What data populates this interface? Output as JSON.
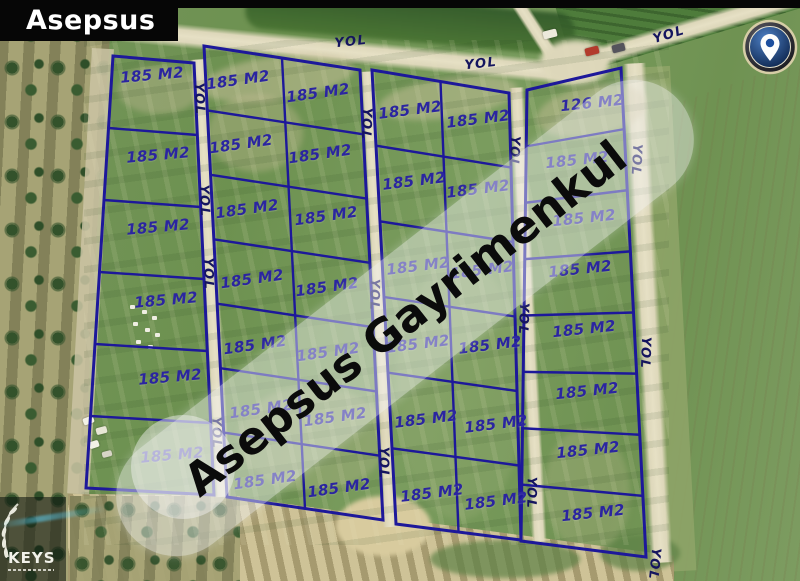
{
  "title_badge": {
    "text": "Asepsus"
  },
  "watermark": {
    "text": "Asepsus Gayrimenkul"
  },
  "logo": {
    "text": "KEYS"
  },
  "colors": {
    "parcel_line": "#1d189a",
    "parcel_label": "#2b25a0",
    "road_label": "#15155f",
    "band": "rgba(245,245,245,0.45)",
    "pin_blue": "#1d4f9e"
  },
  "map": {
    "road_labels": {
      "text": "YOL",
      "positions": [
        {
          "x": 351,
          "y": 42,
          "rot": -6
        },
        {
          "x": 481,
          "y": 64,
          "rot": -6
        },
        {
          "x": 669,
          "y": 35,
          "rot": -17
        },
        {
          "x": 199,
          "y": 99,
          "rot": 88
        },
        {
          "x": 204,
          "y": 201,
          "rot": 88
        },
        {
          "x": 208,
          "y": 274,
          "rot": 89
        },
        {
          "x": 216,
          "y": 433,
          "rot": 89
        },
        {
          "x": 366,
          "y": 124,
          "rot": 92
        },
        {
          "x": 374,
          "y": 295,
          "rot": 91
        },
        {
          "x": 383,
          "y": 463,
          "rot": 90
        },
        {
          "x": 514,
          "y": 152,
          "rot": 93
        },
        {
          "x": 523,
          "y": 319,
          "rot": 92
        },
        {
          "x": 531,
          "y": 493,
          "rot": 91
        },
        {
          "x": 636,
          "y": 160,
          "rot": 93
        },
        {
          "x": 645,
          "y": 353,
          "rot": 92
        },
        {
          "x": 654,
          "y": 564,
          "rot": 96
        }
      ]
    },
    "blocks": [
      {
        "name": "column-west",
        "corners": [
          [
            113,
            56
          ],
          [
            194,
            63
          ],
          [
            214,
            495
          ],
          [
            86,
            488
          ]
        ],
        "rows": 6,
        "cols": 1
      },
      {
        "name": "block-b",
        "corners": [
          [
            204,
            46
          ],
          [
            360,
            70
          ],
          [
            383,
            520
          ],
          [
            227,
            497
          ]
        ],
        "rows": 7,
        "cols": 2
      },
      {
        "name": "block-c",
        "corners": [
          [
            372,
            70
          ],
          [
            509,
            93
          ],
          [
            521,
            540
          ],
          [
            396,
            524
          ]
        ],
        "rows": 6,
        "cols": 2
      },
      {
        "name": "column-east",
        "corners": [
          [
            527,
            90
          ],
          [
            621,
            68
          ],
          [
            646,
            557
          ],
          [
            521,
            541
          ]
        ],
        "rows": 8,
        "cols": 1
      }
    ],
    "plots": [
      {
        "label": "185 M2",
        "x": 152,
        "y": 75,
        "rot": -5
      },
      {
        "label": "185 M2",
        "x": 158,
        "y": 155,
        "rot": -5
      },
      {
        "label": "185 M2",
        "x": 158,
        "y": 227,
        "rot": -5
      },
      {
        "label": "185 M2",
        "x": 166,
        "y": 300,
        "rot": -5
      },
      {
        "label": "185 M2",
        "x": 170,
        "y": 377,
        "rot": -5
      },
      {
        "label": "185 M2",
        "x": 172,
        "y": 455,
        "rot": -5
      },
      {
        "label": "185 M2",
        "x": 238,
        "y": 80,
        "rot": -8
      },
      {
        "label": "185 M2",
        "x": 318,
        "y": 93,
        "rot": -8
      },
      {
        "label": "185 M2",
        "x": 241,
        "y": 144,
        "rot": -8
      },
      {
        "label": "185 M2",
        "x": 320,
        "y": 154,
        "rot": -8
      },
      {
        "label": "185 M2",
        "x": 247,
        "y": 209,
        "rot": -8
      },
      {
        "label": "185 M2",
        "x": 326,
        "y": 216,
        "rot": -8
      },
      {
        "label": "185 M2",
        "x": 252,
        "y": 279,
        "rot": -8
      },
      {
        "label": "185 M2",
        "x": 327,
        "y": 287,
        "rot": -8
      },
      {
        "label": "185 M2",
        "x": 255,
        "y": 345,
        "rot": -8
      },
      {
        "label": "185 M2",
        "x": 328,
        "y": 352,
        "rot": -8
      },
      {
        "label": "185 M2",
        "x": 261,
        "y": 409,
        "rot": -8
      },
      {
        "label": "185 M2",
        "x": 335,
        "y": 417,
        "rot": -8
      },
      {
        "label": "185 M2",
        "x": 265,
        "y": 480,
        "rot": -8
      },
      {
        "label": "185 M2",
        "x": 339,
        "y": 488,
        "rot": -8
      },
      {
        "label": "185 M2",
        "x": 410,
        "y": 110,
        "rot": -7
      },
      {
        "label": "185 M2",
        "x": 478,
        "y": 119,
        "rot": -7
      },
      {
        "label": "185 M2",
        "x": 414,
        "y": 181,
        "rot": -7
      },
      {
        "label": "185 M2",
        "x": 478,
        "y": 189,
        "rot": -7
      },
      {
        "label": "185 M2",
        "x": 418,
        "y": 266,
        "rot": -7
      },
      {
        "label": "185 M2",
        "x": 482,
        "y": 270,
        "rot": -7
      },
      {
        "label": "185 M2",
        "x": 418,
        "y": 344,
        "rot": -7
      },
      {
        "label": "185 M2",
        "x": 490,
        "y": 345,
        "rot": -7
      },
      {
        "label": "185 M2",
        "x": 426,
        "y": 419,
        "rot": -7
      },
      {
        "label": "185 M2",
        "x": 496,
        "y": 424,
        "rot": -7
      },
      {
        "label": "185 M2",
        "x": 432,
        "y": 493,
        "rot": -7
      },
      {
        "label": "185 M2",
        "x": 496,
        "y": 501,
        "rot": -7
      },
      {
        "label": "126 M2",
        "x": 592,
        "y": 103,
        "rot": -6
      },
      {
        "label": "185 M2",
        "x": 577,
        "y": 160,
        "rot": -6
      },
      {
        "label": "185 M2",
        "x": 584,
        "y": 218,
        "rot": -6
      },
      {
        "label": "185 M2",
        "x": 580,
        "y": 269,
        "rot": -6
      },
      {
        "label": "185 M2",
        "x": 584,
        "y": 329,
        "rot": -6
      },
      {
        "label": "185 M2",
        "x": 587,
        "y": 391,
        "rot": -6
      },
      {
        "label": "185 M2",
        "x": 588,
        "y": 450,
        "rot": -6
      },
      {
        "label": "185 M2",
        "x": 593,
        "y": 513,
        "rot": -6
      }
    ]
  }
}
